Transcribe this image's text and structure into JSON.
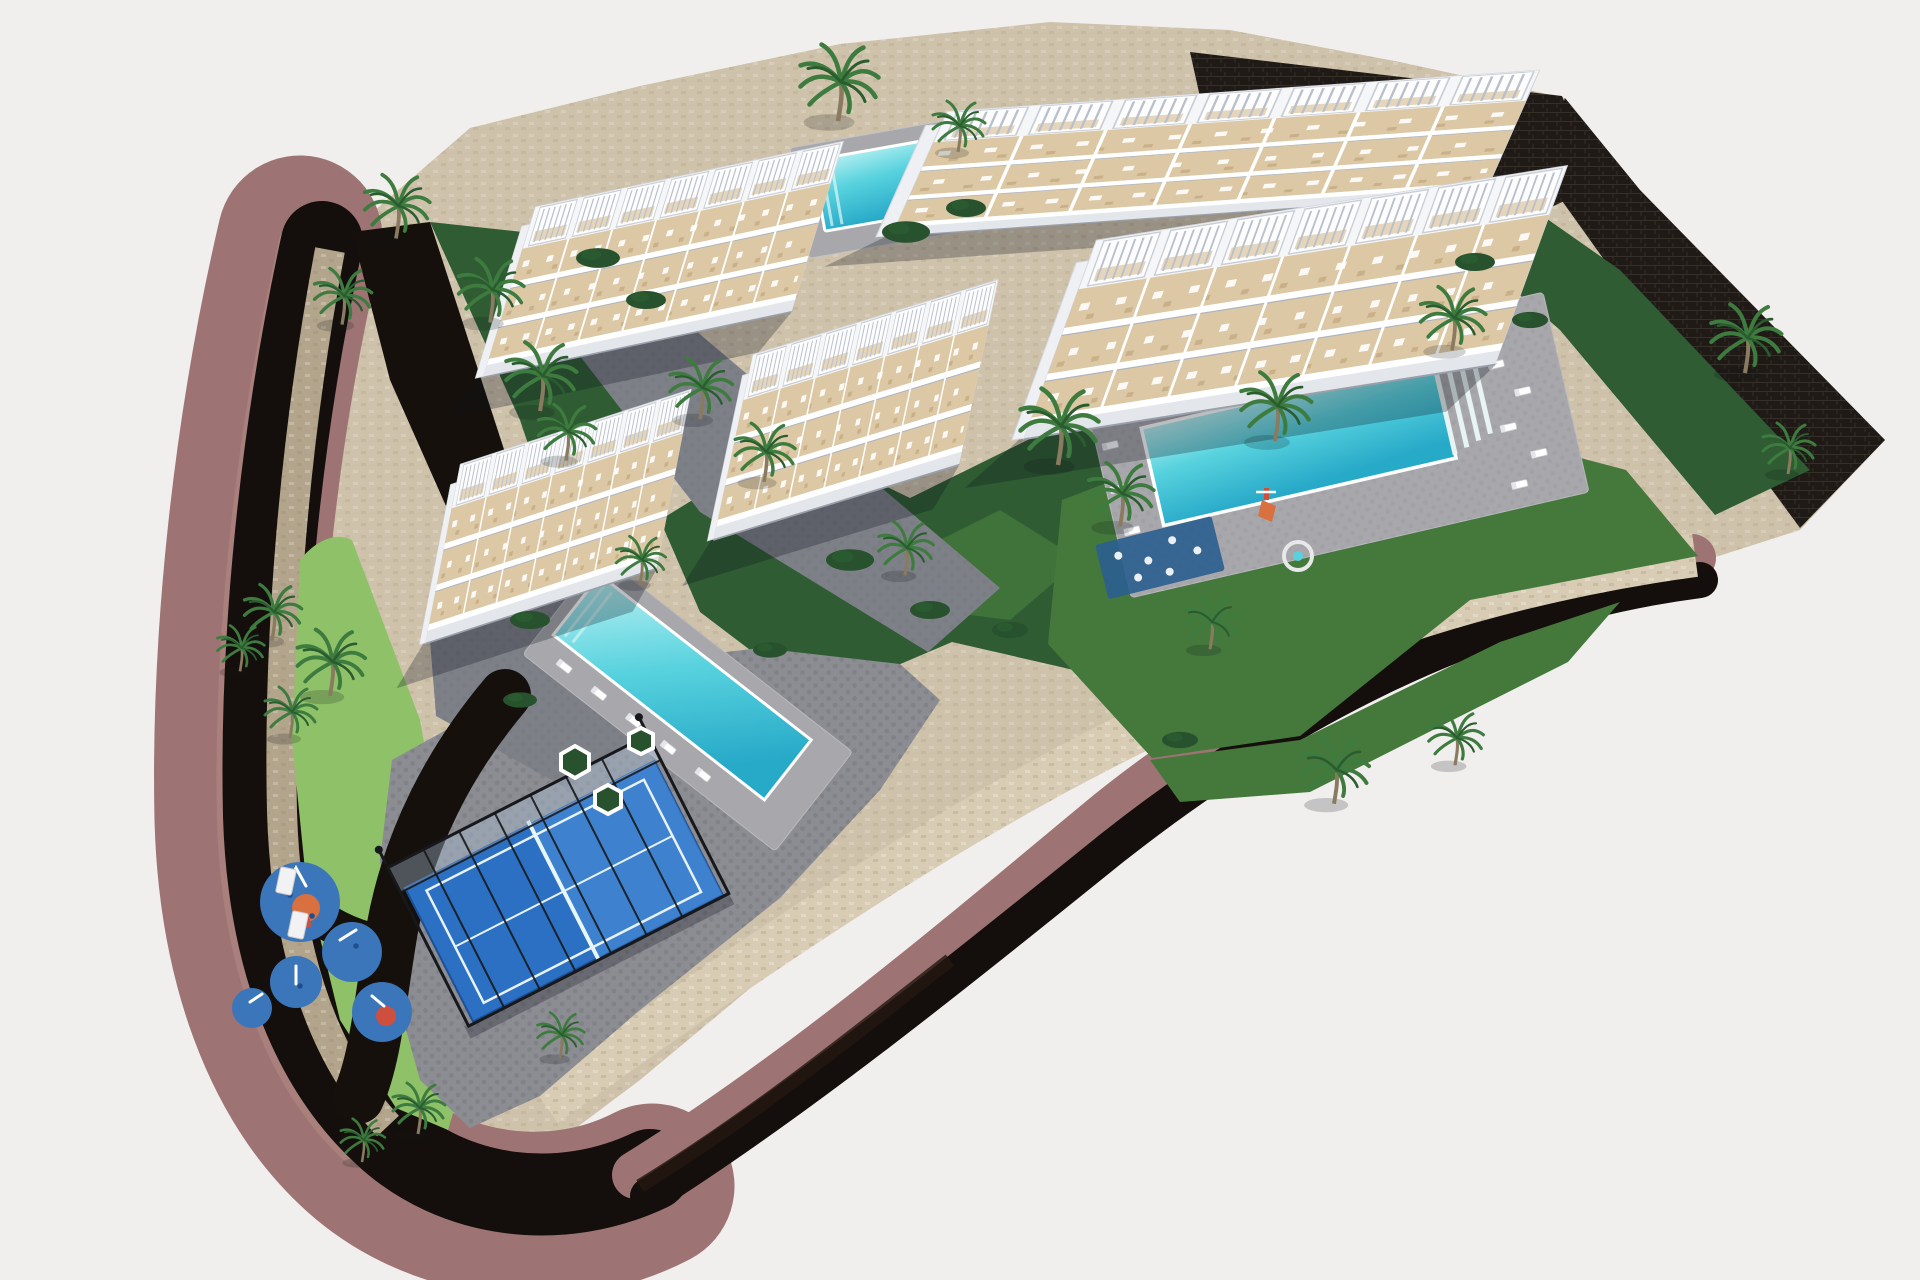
{
  "meta": {
    "title": "Aerial 3D architectural rendering of a terraced apartment complex with pools, padel court and playground",
    "image_type": "architectural-rendering",
    "width_px": 1920,
    "height_px": 1280
  },
  "counts": {
    "apartment_buildings": 5,
    "swimming_pools": 3,
    "padel_courts": 1,
    "playgrounds": 2
  },
  "colors": {
    "background": "#f1efee",
    "road_asphalt": "#140f0c",
    "road_asphalt2": "#241712",
    "sidewalk_mauve": "#9d7473",
    "sidewalk_mauve_light": "#b28a84",
    "site_stone": "#cfc2ab",
    "site_stone_dark": "#b3a58c",
    "walkway_speckle": "#d8cdb4",
    "dark_wall": "#1f1a16",
    "drive_asphalt": "#15100c",
    "plaza_gray": "#8c8d92",
    "plaza_dot": "#74757b",
    "cobble_gray": "#7e8088",
    "lawn_bright": "#8fc268",
    "lawn_mid": "#45793c",
    "lawn_dark": "#2f5c33",
    "garden_dark": "#28512e",
    "palm_green": "#3e7b3f",
    "palm_dark": "#2a5c2f",
    "trunk_brown": "#8a7a5f",
    "building_white": "#f5f6f8",
    "building_edge": "#d3d7de",
    "facade_shade": "#e3e6ea",
    "terrace_beige": "#dcc8a4",
    "terrace_beige_dark": "#c9b089",
    "railing_white": "#ffffff",
    "pool_light": "#baf1f2",
    "pool_mid": "#57d2de",
    "pool_deep": "#27a9c8",
    "deck_gray": "#a8a8ac",
    "wood_deck": "#6e5440",
    "padel_blue": "#2c70c3",
    "padel_blue_light": "#4e92d8",
    "padel_frame": "#17181b",
    "net_white": "#e8f6f8",
    "play_blue": "#3b76ba",
    "play_orange": "#d8703f",
    "play_red": "#cf4f3e",
    "splash_blue": "#2b5e8f",
    "shadow": "rgba(15,18,28,0.28)"
  },
  "scene": {
    "labels": {
      "site": "Wedge-shaped development plot on beige stone platform",
      "road": "Dark asphalt perimeter road curving around the plot",
      "sidewalk": "Mauve pedestrian sidewalk along the road",
      "walls": "Dark stone retaining walls on upper and right boundary",
      "walkway": "Beige stone walkway along the lower site edge",
      "b1": "Terraced apartment building 1 (top left) with rooftop pergolas",
      "b2": "Terraced apartment building 2 (top right) with rooftop pergolas",
      "b3": "Terraced apartment building 3 (right) with rooftop pergolas",
      "b4": "Terraced apartment building 4 (center) with rooftop pergolas",
      "b5": "Terraced apartment building 5 (left) with rooftop pergolas",
      "pool_top": "Small swimming pool with sun deck between buildings 1 and 2",
      "pool_right": "Large community swimming pool with roman steps and loungers",
      "pool_center": "Community swimming pool beside building 5 with lounger row",
      "padel": "Fenced padel tennis court with blue surface",
      "playground": "Children's playground with blue rubber safety pads",
      "kids_area": "Kids play corner with slide and spa circle in the garden",
      "garden": "Central landscaped garden with palm trees",
      "plaza": "Gray cobbled pedestrian plaza",
      "driveway": "Internal asphalt driveway from the street gate",
      "lawns": "Bright green lawn strips along the road",
      "palms": "Palm tree",
      "gate": "White entrance gate pillars",
      "planters": "Hexagonal white planters with shrubs",
      "splash": "Splash fountain pad with water jets"
    }
  }
}
